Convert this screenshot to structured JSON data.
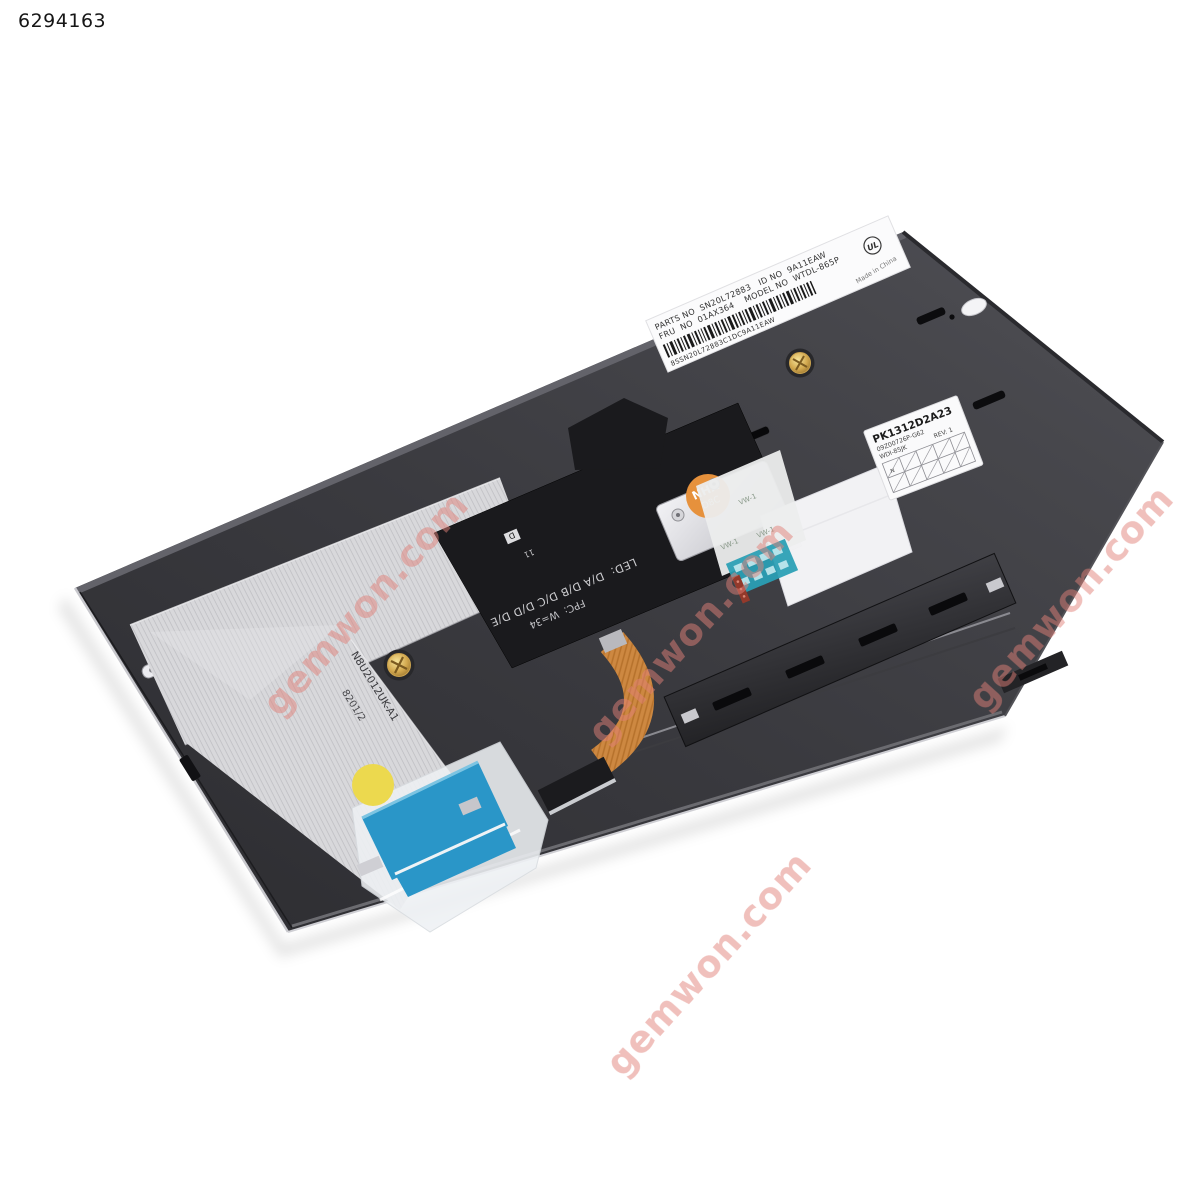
{
  "photo": {
    "id": "6294163"
  },
  "watermark": {
    "text": "gemwon.com",
    "color": "#e08078"
  },
  "keyboard": {
    "barcode_label": {
      "line1": "PARTS NO  SN20L72883   ID NO  9A11EAW",
      "line2": "FRU  NO  01AX364    MODEL NO  WTDL-865P",
      "barcode_number": "8SSN20L72883C1DC9A11EAW",
      "origin": "Made in China",
      "cert_mark": "UL"
    },
    "pk_label": {
      "part_number": "PK1312D2A23",
      "sub_number": "09Z00726P-G62",
      "model_code": "WDI-85JK",
      "revision": "REV: 1",
      "grid_mark": "N"
    },
    "flex_markings": {
      "led_spec": "LED:  D/A D/B D/C D/D D/E",
      "fpc_spec": "FPC:  W=34",
      "d_mark": "D",
      "num_mark": "11"
    },
    "ribbon_markings": {
      "part_number": "N8U2012UK-A1",
      "batch_code": "8201/2"
    },
    "panel_emboss": "Y-1",
    "bracket_sticker": {
      "line1": "NHX",
      "line2": "D8C"
    },
    "sleeve_marking": "VW-1"
  }
}
